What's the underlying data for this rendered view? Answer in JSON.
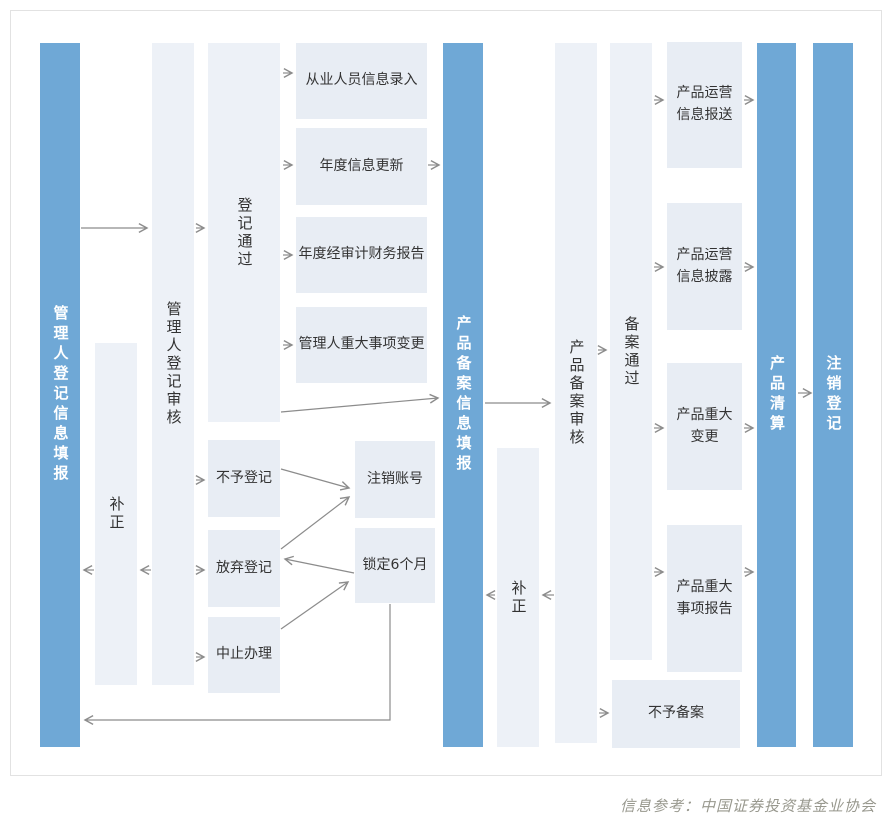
{
  "caption": "信息参考：中国证券投资基金业协会",
  "colors": {
    "bar": "#6fa8d6",
    "bar_text": "#ffffff",
    "column_bg": "#edf1f7",
    "box_bg": "#e8edf4",
    "node_text": "#333333",
    "arrow": "#8c8c8c",
    "card_border": "#e2e2e2",
    "card_bg": "#ffffff",
    "caption": "#98988e"
  },
  "bars": [
    {
      "id": "manager-registration-info-fill",
      "label": "管理人登记信息填报"
    },
    {
      "id": "product-filing-info-fill",
      "label": "产品备案信息填报"
    },
    {
      "id": "product-liquidation",
      "label": "产品清算"
    },
    {
      "id": "deregistration",
      "label": "注销登记"
    }
  ],
  "columns": [
    {
      "id": "correction-1",
      "label": "补正"
    },
    {
      "id": "manager-registration-review",
      "label": "管理人登记审核"
    },
    {
      "id": "registration-passed",
      "label": "登记通过"
    },
    {
      "id": "correction-2",
      "label": "补正"
    },
    {
      "id": "product-filing-review",
      "label": "产品备案审核"
    },
    {
      "id": "filing-passed",
      "label": "备案通过"
    }
  ],
  "boxes": [
    {
      "id": "staff-info-entry",
      "label": "从业人员信息录入"
    },
    {
      "id": "annual-info-update",
      "label": "年度信息更新"
    },
    {
      "id": "annual-audited-financial-report",
      "label": "年度经审计财务报告"
    },
    {
      "id": "manager-major-event-change",
      "label": "管理人重大事项变更"
    },
    {
      "id": "no-registration",
      "label": "不予登记"
    },
    {
      "id": "abandon-registration",
      "label": "放弃登记"
    },
    {
      "id": "suspend-processing",
      "label": "中止办理"
    },
    {
      "id": "cancel-account",
      "label": "注销账号"
    },
    {
      "id": "lock-6-months",
      "label": "锁定6个月"
    },
    {
      "id": "product-operation-info-submission",
      "label": "产品运营\n信息报送"
    },
    {
      "id": "product-operation-info-disclosure",
      "label": "产品运营\n信息披露"
    },
    {
      "id": "product-major-change",
      "label": "产品重大\n变更"
    },
    {
      "id": "product-major-event-report",
      "label": "产品重大\n事项报告"
    },
    {
      "id": "no-filing",
      "label": "不予备案"
    }
  ]
}
